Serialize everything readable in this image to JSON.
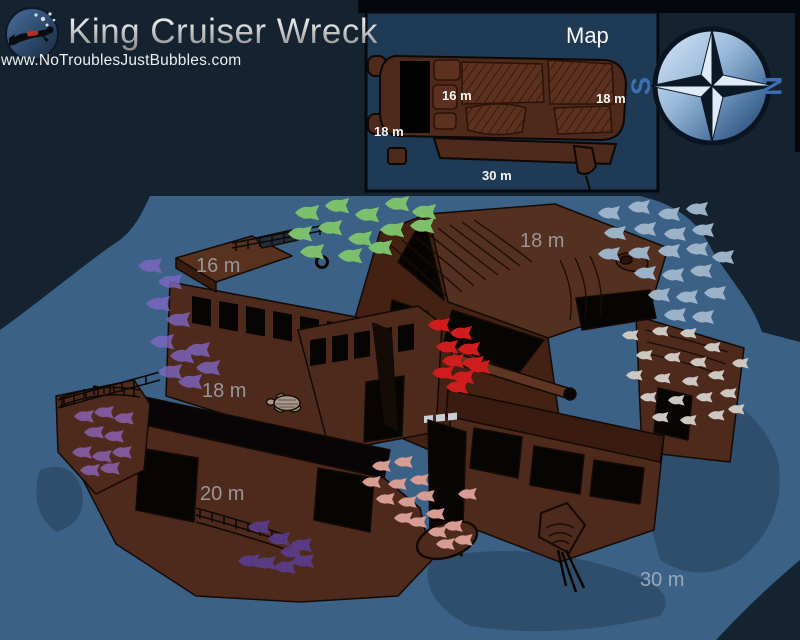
{
  "header": {
    "title": "King Cruiser Wreck",
    "url": "www.NoTroublesJustBubbles.com",
    "logo": "scuba-diver-icon"
  },
  "map_inset": {
    "title": "Map",
    "labels": {
      "mid_deck": "16 m",
      "stern": "18 m",
      "bow": "18 m",
      "seabed": "30 m"
    }
  },
  "compass": {
    "west": "S",
    "east": "N"
  },
  "scene_labels": {
    "wheelhouse_roof": "16 m",
    "stern_deck": "18 m",
    "port_deck": "18 m",
    "lower_deck": "20 m",
    "seabed": "30 m"
  },
  "colors": {
    "background": "#15222f",
    "top_bar": "#04070b",
    "seafloor": "#3b6187",
    "seafloor_shadow": "#2f4e6b",
    "panel": "#1e3a54",
    "wreck": "#4e2a1c",
    "wreck_dark": "#432113",
    "wreck_light": "#53301f",
    "opening": "#070404",
    "label": "#979797",
    "label_seabed": "#9aa8b8",
    "map_label": "#f5f5f5",
    "compass_letter": "#3c70b2",
    "fish_green": "#7dc06c",
    "fish_silver": "#9cb2c6",
    "fish_purple": "#7e66c2",
    "fish_red": "#cf1d1d",
    "fish_white": "#cdc7c1",
    "fish_pink": "#d79d92",
    "fish_violet": "#8a62b0",
    "fish_dark_purple": "#5c3f96",
    "turtle": "#a9988a"
  }
}
